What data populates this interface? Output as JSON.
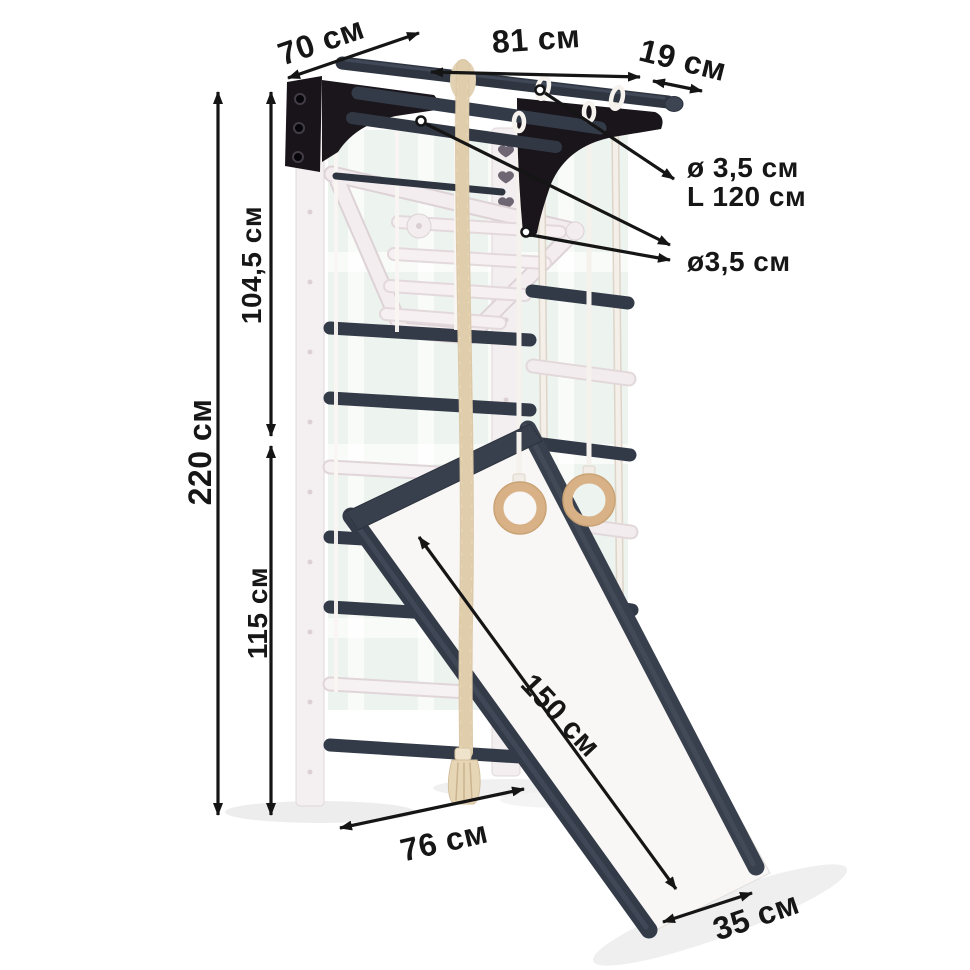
{
  "dimensions": {
    "top_depth": "70 см",
    "top_width": "81 см",
    "bar_overhang": "19 см",
    "upper_section_height": "104,5 см",
    "total_height": "220 см",
    "lower_section_height": "115 см",
    "bar_spec_diameter": "ø 3,5 см",
    "bar_spec_length": "L 120 см",
    "rung_diameter": "ø3,5 см",
    "slide_length": "150 см",
    "base_depth": "76 см",
    "slide_width": "35 см"
  },
  "colors": {
    "dark_bars": "#343b48",
    "black_brackets": "#18141a",
    "white_wood": "#f4eff1",
    "rope_beige": "#e7d6b6",
    "ring_wood": "#d8b187",
    "wall_reflection": "#ebf1ec",
    "dimension_ink": "#151515"
  }
}
